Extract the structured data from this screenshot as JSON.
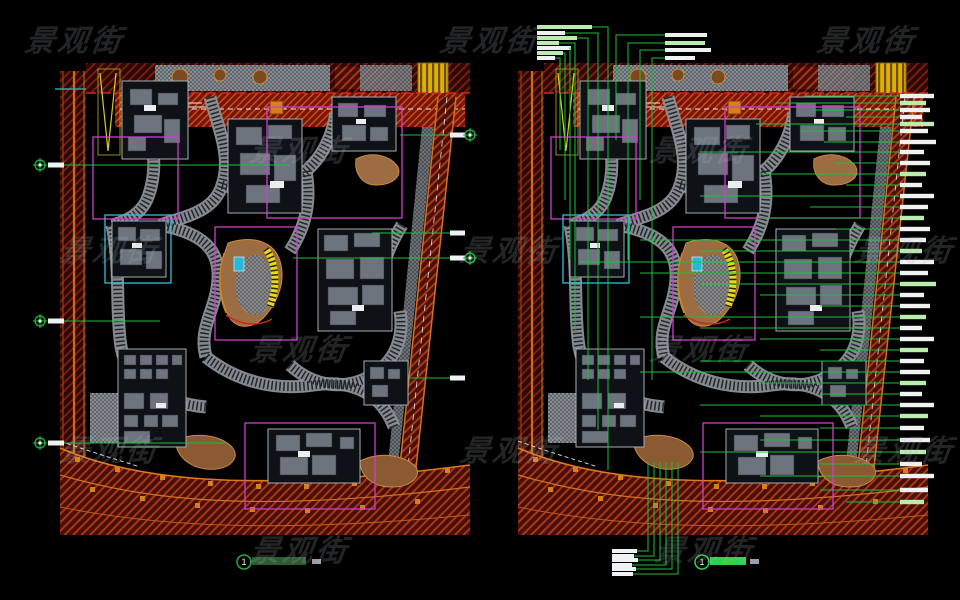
{
  "watermark": {
    "text": "景观街",
    "positions": [
      [
        75,
        38
      ],
      [
        490,
        38
      ],
      [
        867,
        38
      ],
      [
        300,
        148
      ],
      [
        700,
        148
      ],
      [
        110,
        248
      ],
      [
        510,
        248
      ],
      [
        905,
        248
      ],
      [
        300,
        347
      ],
      [
        700,
        347
      ],
      [
        110,
        448
      ],
      [
        510,
        448
      ],
      [
        905,
        448
      ],
      [
        300,
        548
      ],
      [
        705,
        548
      ]
    ]
  },
  "palette": {
    "annotation_green": "#1fbf3a",
    "bright_green": "#2bd24a",
    "label_white": "#f0f1f2",
    "label_pale_green": "#b9ecad",
    "road_dark_red": "#2a0a05",
    "road_hatch_red": "#8f1d0e",
    "main_road_red": "#7a1408",
    "road_edge_orange": "#d3701c",
    "walk_gray": "#8a9096",
    "boundary_magenta": "#cf3ccf",
    "boundary_cyan": "#2ec0dc",
    "water_cyan": "#28b8d8",
    "stair_yellow": "#e8d818",
    "mound_tan": "#9c6c42",
    "highlight_yellow": "#e2ae06"
  },
  "figures": {
    "left": {
      "number": "1",
      "circle": [
        244,
        562
      ],
      "title_rect": [
        252,
        557,
        54,
        8
      ],
      "title_color": "#2e5a32",
      "scale_rect": [
        312,
        559,
        9,
        5
      ]
    },
    "right": {
      "number": "1",
      "circle": [
        702,
        562
      ],
      "title_rect": [
        710,
        557,
        36,
        8
      ],
      "title_color": "#2bd24a",
      "scale_rect": [
        750,
        559,
        9,
        5
      ]
    }
  },
  "annotations": {
    "left": {
      "edge_tick": {
        "x1": 55,
        "x2": 86,
        "y": 89
      },
      "left_callouts": [
        {
          "y": 165,
          "x2": 290
        },
        {
          "y": 321,
          "x2": 160
        },
        {
          "y": 443,
          "x2": 225
        }
      ],
      "right_callouts": [
        {
          "y": 135,
          "x1": 400,
          "circle": true
        },
        {
          "y": 233,
          "x1": 372,
          "circle": false
        },
        {
          "y": 258,
          "x1": 293,
          "circle": true
        },
        {
          "y": 378,
          "x1": 410,
          "circle": false
        }
      ]
    },
    "right": {
      "top_labels": [
        {
          "x": 537,
          "y": 25,
          "w": 55,
          "c": "g",
          "vx": 608,
          "vy": 470
        },
        {
          "x": 537,
          "y": 31,
          "w": 28,
          "c": "w",
          "vx": 598,
          "vy": 430
        },
        {
          "x": 537,
          "y": 36,
          "w": 40,
          "c": "g",
          "vx": 588,
          "vy": 380
        },
        {
          "x": 537,
          "y": 41,
          "w": 22,
          "c": "g",
          "vx": 575,
          "vy": 330
        },
        {
          "x": 537,
          "y": 46,
          "w": 34,
          "c": "w",
          "vx": 570,
          "vy": 260
        },
        {
          "x": 537,
          "y": 51,
          "w": 26,
          "c": "g",
          "vx": 565,
          "vy": 200
        },
        {
          "x": 537,
          "y": 56,
          "w": 18,
          "c": "w",
          "vx": 560,
          "vy": 150
        },
        {
          "x": 665,
          "y": 33,
          "w": 42,
          "c": "w",
          "vx": 616,
          "vy": 140
        },
        {
          "x": 665,
          "y": 41,
          "w": 40,
          "c": "g",
          "vx": 628,
          "vy": 260
        },
        {
          "x": 665,
          "y": 48,
          "w": 46,
          "c": "w",
          "vx": 640,
          "vy": 200
        },
        {
          "x": 665,
          "y": 56,
          "w": 30,
          "c": "w",
          "vx": 652,
          "vy": 380
        }
      ],
      "right_labels": [
        {
          "y": 96,
          "x1": 806,
          "w": 34,
          "c": "w"
        },
        {
          "y": 103,
          "x1": 776,
          "w": 26,
          "c": "g"
        },
        {
          "y": 110,
          "x1": 812,
          "w": 30,
          "c": "w"
        },
        {
          "y": 117,
          "x1": 846,
          "w": 22,
          "c": "w"
        },
        {
          "y": 124,
          "x1": 756,
          "w": 34,
          "c": "g"
        },
        {
          "y": 131,
          "x1": 800,
          "w": 28,
          "c": "w"
        },
        {
          "y": 142,
          "x1": 824,
          "w": 36,
          "c": "w"
        },
        {
          "y": 152,
          "x1": 700,
          "w": 24,
          "c": "w"
        },
        {
          "y": 163,
          "x1": 836,
          "w": 30,
          "c": "w"
        },
        {
          "y": 174,
          "x1": 760,
          "w": 26,
          "c": "g"
        },
        {
          "y": 185,
          "x1": 846,
          "w": 22,
          "c": "w"
        },
        {
          "y": 196,
          "x1": 700,
          "w": 34,
          "c": "w"
        },
        {
          "y": 207,
          "x1": 810,
          "w": 28,
          "c": "w"
        },
        {
          "y": 218,
          "x1": 760,
          "w": 24,
          "c": "g"
        },
        {
          "y": 229,
          "x1": 836,
          "w": 30,
          "c": "w"
        },
        {
          "y": 240,
          "x1": 640,
          "w": 26,
          "c": "w"
        },
        {
          "y": 251,
          "x1": 700,
          "w": 22,
          "c": "g"
        },
        {
          "y": 262,
          "x1": 580,
          "w": 34,
          "c": "w"
        },
        {
          "y": 273,
          "x1": 640,
          "w": 28,
          "c": "w"
        },
        {
          "y": 284,
          "x1": 700,
          "w": 36,
          "c": "g"
        },
        {
          "y": 295,
          "x1": 760,
          "w": 24,
          "c": "w"
        },
        {
          "y": 306,
          "x1": 820,
          "w": 30,
          "c": "w"
        },
        {
          "y": 317,
          "x1": 640,
          "w": 26,
          "c": "g"
        },
        {
          "y": 328,
          "x1": 700,
          "w": 22,
          "c": "w"
        },
        {
          "y": 339,
          "x1": 760,
          "w": 34,
          "c": "w"
        },
        {
          "y": 350,
          "x1": 820,
          "w": 28,
          "c": "g"
        },
        {
          "y": 361,
          "x1": 700,
          "w": 24,
          "c": "w"
        },
        {
          "y": 372,
          "x1": 640,
          "w": 30,
          "c": "w"
        },
        {
          "y": 383,
          "x1": 760,
          "w": 26,
          "c": "g"
        },
        {
          "y": 394,
          "x1": 820,
          "w": 22,
          "c": "w"
        },
        {
          "y": 405,
          "x1": 700,
          "w": 34,
          "c": "w"
        },
        {
          "y": 416,
          "x1": 760,
          "w": 28,
          "c": "g"
        },
        {
          "y": 428,
          "x1": 820,
          "w": 24,
          "c": "w"
        },
        {
          "y": 440,
          "x1": 760,
          "w": 30,
          "c": "w"
        },
        {
          "y": 452,
          "x1": 700,
          "w": 26,
          "c": "g"
        },
        {
          "y": 464,
          "x1": 820,
          "w": 22,
          "c": "w"
        },
        {
          "y": 476,
          "x1": 760,
          "w": 34,
          "c": "w"
        },
        {
          "y": 490,
          "x1": 820,
          "w": 28,
          "c": "w"
        },
        {
          "y": 502,
          "x1": 846,
          "w": 24,
          "c": "g"
        }
      ],
      "bottom_labels": {
        "bar_x": 612,
        "vy_top": 462,
        "vx_start": 648,
        "vx_step": 6,
        "items": [
          {
            "y": 551,
            "w": 25
          },
          {
            "y": 556,
            "w": 22
          },
          {
            "y": 560,
            "w": 26
          },
          {
            "y": 565,
            "w": 20
          },
          {
            "y": 569,
            "w": 24
          },
          {
            "y": 574,
            "w": 21
          }
        ]
      }
    }
  }
}
